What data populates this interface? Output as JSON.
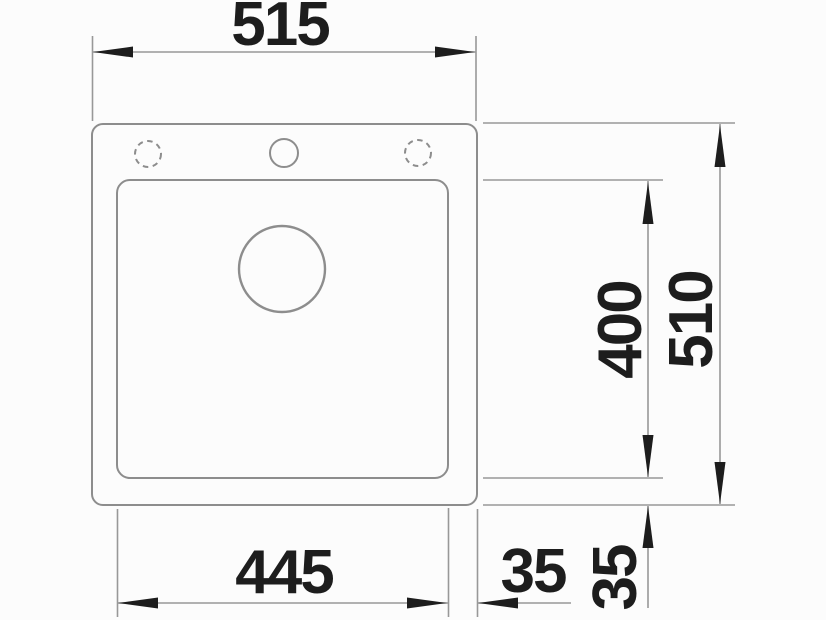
{
  "drawing": {
    "type": "sink-installation-dimension-drawing",
    "labels": {
      "outer_width": "515",
      "outer_height": "510",
      "basin_width": "445",
      "basin_height": "400",
      "rim_right": "35",
      "rim_bottom": "35"
    },
    "colors": {
      "background": "#fcfcfc",
      "outline": "#8d8d8d",
      "dimline": "#989898",
      "ink": "#1d1d1d"
    }
  }
}
